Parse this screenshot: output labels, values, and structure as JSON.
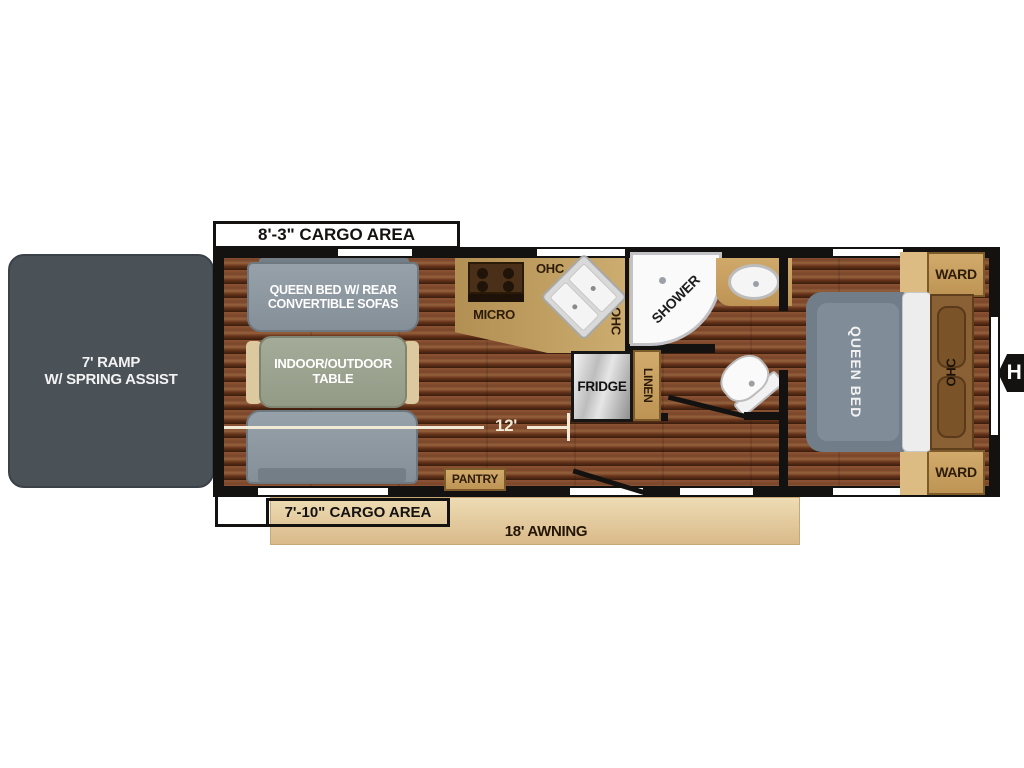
{
  "title": "Travel trailer floor plan",
  "labels": {
    "cargo_top": "8'-3\" CARGO AREA",
    "cargo_bottom": "7'-10\" CARGO AREA",
    "awning": "18' AWNING",
    "length": "12'",
    "ramp": "7' RAMP\nW/ SPRING ASSIST",
    "sofa": "QUEEN BED W/ REAR\nCONVERTIBLE SOFAS",
    "table": "INDOOR/OUTDOOR\nTABLE",
    "micro": "MICRO",
    "ohc": "OHC",
    "shower": "SHOWER",
    "fridge": "FRIDGE",
    "linen": "LINEN",
    "pantry": "PANTRY",
    "queen_bed": "QUEEN BED",
    "ward": "WARD",
    "hitch": "H"
  },
  "colors": {
    "wall": "#141210",
    "wood_dark": "#69341b",
    "wood_light": "#94613d",
    "cabinet_tan": "#c7a05f",
    "counter_tan": "#bc9a5e",
    "sofa_gray": "#8d97a0",
    "table_green": "#9aa18e",
    "bed_gray": "#76838f",
    "ramp_gray": "#4a5157",
    "awning_tan": "#e7d2a6",
    "dim_line_cream": "#f2ead6"
  }
}
